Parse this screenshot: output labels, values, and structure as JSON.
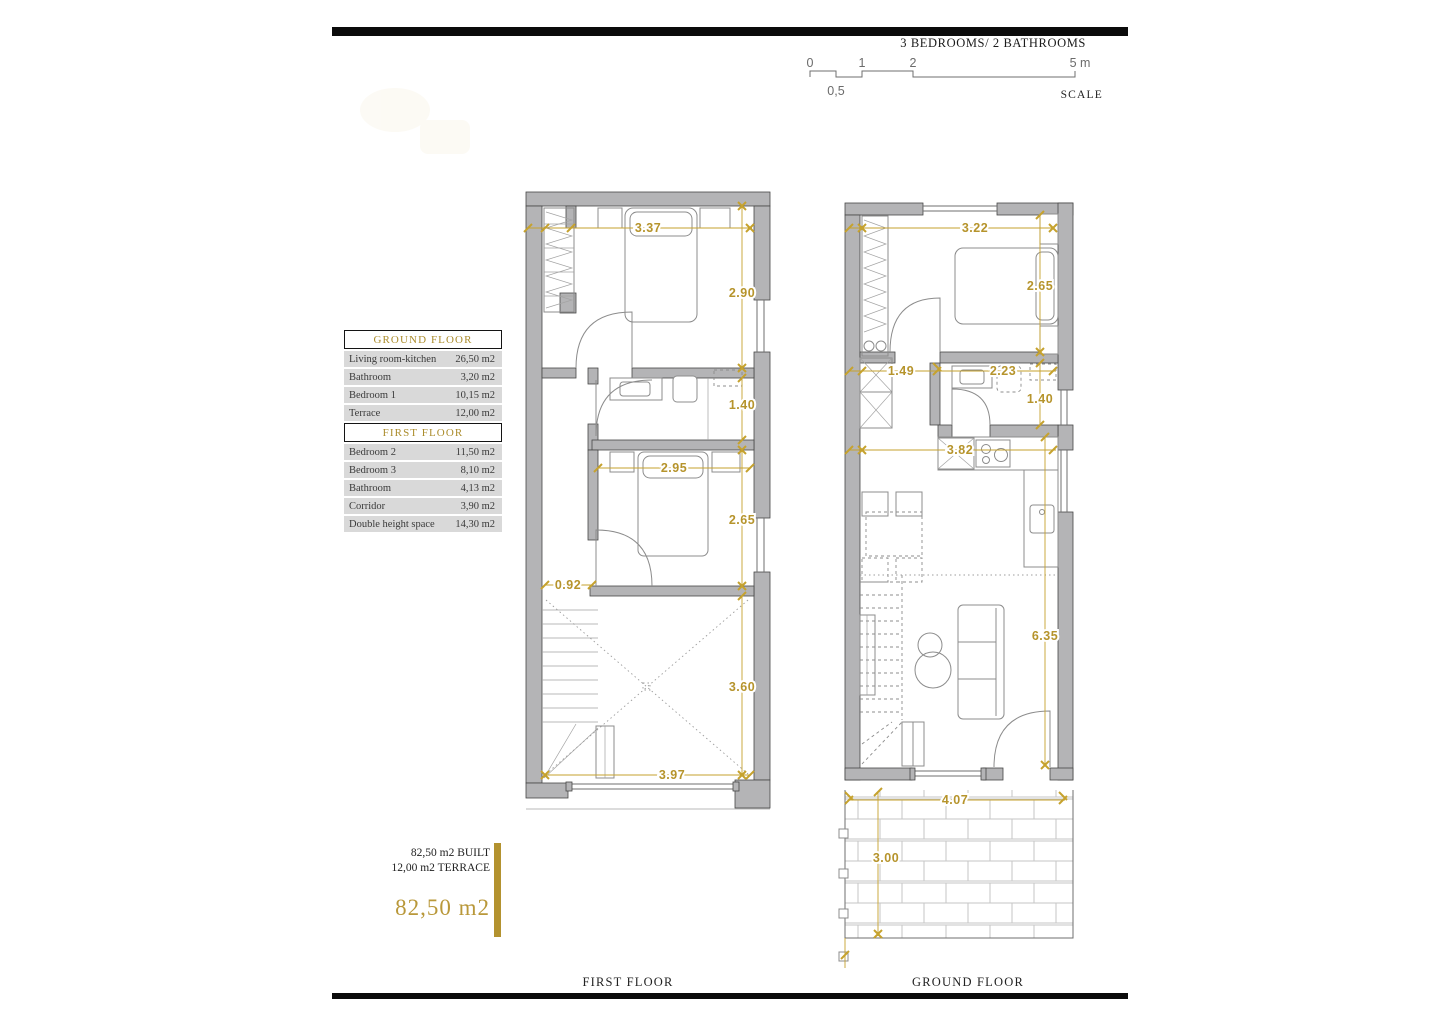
{
  "header": {
    "title": "3 BEDROOMS/ 2 BATHROOMS"
  },
  "scale": {
    "tick_0": "0",
    "tick_1": "1",
    "tick_2": "2",
    "tick_5": "5 m",
    "half": "0,5",
    "label": "SCALE"
  },
  "area_table": {
    "sections": [
      {
        "title": "GROUND FLOOR",
        "rows": [
          {
            "name": "Living room-kitchen",
            "area": "26,50 m2"
          },
          {
            "name": "Bathroom",
            "area": "3,20 m2"
          },
          {
            "name": "Bedroom 1",
            "area": "10,15 m2"
          },
          {
            "name": "Terrace",
            "area": "12,00 m2"
          }
        ]
      },
      {
        "title": "FIRST FLOOR",
        "rows": [
          {
            "name": "Bedroom 2",
            "area": "11,50 m2"
          },
          {
            "name": "Bedroom 3",
            "area": "8,10 m2"
          },
          {
            "name": "Bathroom",
            "area": "4,13 m2"
          },
          {
            "name": "Corridor",
            "area": "3,90 m2"
          },
          {
            "name": "Double height space",
            "area": "14,30 m2"
          }
        ]
      }
    ]
  },
  "summary": {
    "built": "82,50 m2 BUILT",
    "terrace": "12,00 m2 TERRACE",
    "total": "82,50 m2"
  },
  "first_floor": {
    "label": "FIRST FLOOR",
    "dims": {
      "w_bedroom2": "3.37",
      "h_bedroom2": "2.90",
      "h_bathroom": "1.40",
      "w_bedroom3": "2.95",
      "h_bedroom3": "2.65",
      "w_stair": "0.92",
      "h_void": "3.60",
      "w_void": "3.97"
    }
  },
  "ground_floor": {
    "label": "GROUND FLOOR",
    "dims": {
      "w_bedroom1": "3.22",
      "h_bedroom1": "2.65",
      "w_hall": "1.49",
      "w_bathroom": "2.23",
      "h_bathroom": "1.40",
      "w_kitchen": "3.82",
      "h_living": "6.35",
      "w_terrace": "4.07",
      "h_terrace": "3.00"
    }
  },
  "colors": {
    "accent_gold": "#b6942c",
    "wall_gray": "#b4b4b6",
    "row_gray": "#d9d9d9"
  }
}
